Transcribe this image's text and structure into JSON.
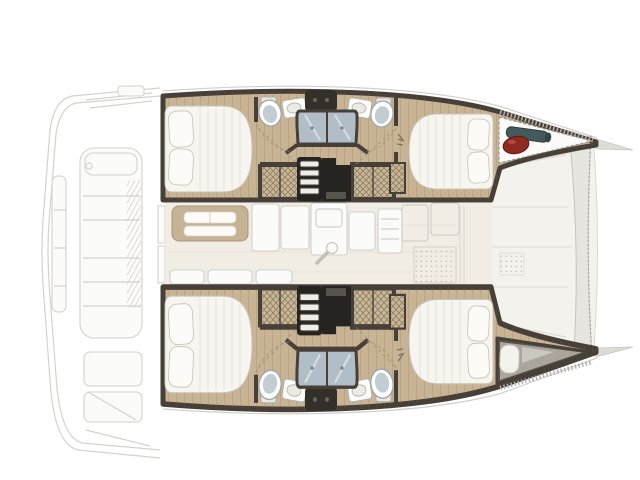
{
  "image": {
    "title": "Catamaran yacht four-cabin interior deck plan, top view, bow to the right",
    "orientation": "bow right, stern left"
  },
  "colors": {
    "background": "#ffffff",
    "hull_wall": "#474039",
    "wood_floor": "#c8b494",
    "salon_floor": "#f1ede4",
    "deck_panel": "#f4f2ec",
    "beam_gray": "#e7e5e0",
    "locker_white": "#fcfbf9",
    "bed": "#f7f5ef",
    "bed_edge": "#c7c2b6",
    "pillow": "#fcfbf7",
    "shower": "#b2bec7",
    "toilet": "#ffffff",
    "toilet_seat": "#c2cdd3",
    "counter_dark": "#33302b",
    "wardrobe": "#c9b795",
    "stair_well": "#262420",
    "stair_step": "#efede7",
    "berth_dark": "#5a544d",
    "berth_floor": "#aaa69e",
    "windlass_red": "#8e2a21",
    "windlass_teal": "#435a5d",
    "line_art": "#d2d0cc",
    "hatch_band": "#b5b1ab"
  },
  "regions": {
    "aft_cockpit": "aft cockpit and transom, faint line art",
    "port_hull_top": [
      "aft double cabin",
      "aft bathroom with shower",
      "forward bathroom with shower",
      "forward double cabin",
      "anchor windlass locker"
    ],
    "starboard_hull_bottom": [
      "aft double cabin",
      "aft bathroom with shower",
      "forward bathroom with shower",
      "forward double cabin",
      "forepeak berth"
    ],
    "salon": [
      "dining table",
      "galley units",
      "refrigerator",
      "aft settee",
      "entry mat",
      "winch handle"
    ],
    "foredeck": "forward bridgedeck panels with cross beam"
  },
  "fixtures": {
    "beds": 4,
    "toilets": 4,
    "sinks": 4,
    "showers": 4,
    "wardrobes": 4,
    "companionway_stairs": 2
  }
}
